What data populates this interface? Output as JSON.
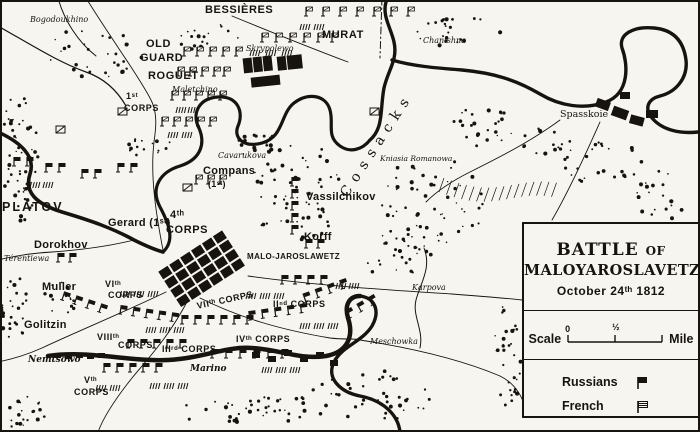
{
  "colors": {
    "ink": "#17140f",
    "paper": "#f7f5f0"
  },
  "map": {
    "labels": [
      {
        "id": "bogodoukhino",
        "text": "Bogodoukhino",
        "x": 30,
        "y": 16,
        "cls": "it"
      },
      {
        "id": "bessieres",
        "text": "BESSIÈRES",
        "x": 205,
        "y": 5,
        "cls": "caps md"
      },
      {
        "id": "murat",
        "text": "MURAT",
        "x": 322,
        "y": 30,
        "cls": "caps md"
      },
      {
        "id": "skrypolewo",
        "text": "Skrypolewo",
        "x": 246,
        "y": 45,
        "cls": "it"
      },
      {
        "id": "old-guard-1",
        "text": "OLD",
        "x": 146,
        "y": 39,
        "cls": "caps md"
      },
      {
        "id": "old-guard-2",
        "text": "GUARD",
        "x": 140,
        "y": 53,
        "cls": "caps md"
      },
      {
        "id": "roguet",
        "text": "ROGUET",
        "x": 148,
        "y": 71,
        "cls": "caps md"
      },
      {
        "id": "maletchino",
        "text": "Maletchino",
        "x": 172,
        "y": 86,
        "cls": "it"
      },
      {
        "id": "corps1-a",
        "text": "1ˢᵗ",
        "x": 126,
        "y": 92,
        "cls": "caps sm"
      },
      {
        "id": "corps1-b",
        "text": "CORPS",
        "x": 124,
        "y": 104,
        "cls": "caps sm"
      },
      {
        "id": "cossacks",
        "text": "Cossacks",
        "x": 338,
        "y": 192,
        "cls": "cossacks",
        "rot": -57
      },
      {
        "id": "chanishna",
        "text": "Chanishna",
        "x": 423,
        "y": 37,
        "cls": "it"
      },
      {
        "id": "spasskoie",
        "text": "Spasskoie",
        "x": 560,
        "y": 110,
        "cls": "rm"
      },
      {
        "id": "cavarukova",
        "text": "Cavarukova",
        "x": 218,
        "y": 152,
        "cls": "it"
      },
      {
        "id": "compans-a",
        "text": "Compans",
        "x": 203,
        "y": 166,
        "cls": "hand"
      },
      {
        "id": "compans-b",
        "text": "(1ˢᵗ)",
        "x": 208,
        "y": 180,
        "cls": "hand sm"
      },
      {
        "id": "vassilchikov",
        "text": "Vassilchikov",
        "x": 306,
        "y": 192,
        "cls": "hand"
      },
      {
        "id": "korff",
        "text": "Korff",
        "x": 304,
        "y": 232,
        "cls": "hand"
      },
      {
        "id": "kniasia-romanowa",
        "text": "Kniasia Romanowa",
        "x": 380,
        "y": 155,
        "cls": "rm xs"
      },
      {
        "id": "platov",
        "text": "PLATOV",
        "x": 2,
        "y": 201,
        "cls": "caps lg"
      },
      {
        "id": "corps4-a",
        "text": "4ᵗʰ",
        "x": 170,
        "y": 210,
        "cls": "caps md"
      },
      {
        "id": "corps4-b",
        "text": "CORPS",
        "x": 166,
        "y": 225,
        "cls": "caps md"
      },
      {
        "id": "gerard",
        "text": "Gerard (1ˢᵗ)",
        "x": 108,
        "y": 218,
        "cls": "hand"
      },
      {
        "id": "dorokhov",
        "text": "Dorokhov",
        "x": 34,
        "y": 240,
        "cls": "hand"
      },
      {
        "id": "terentiewa",
        "text": "Térentiewa",
        "x": 4,
        "y": 255,
        "cls": "it"
      },
      {
        "id": "malo-jaroslawetz",
        "text": "MALO-JAROSLAWETZ",
        "x": 247,
        "y": 253,
        "cls": "town"
      },
      {
        "id": "muller",
        "text": "Muller",
        "x": 42,
        "y": 282,
        "cls": "hand"
      },
      {
        "id": "corps6-a",
        "text": "VIᵗʰ",
        "x": 105,
        "y": 280,
        "cls": "caps sm"
      },
      {
        "id": "corps6-b",
        "text": "CORPS",
        "x": 108,
        "y": 291,
        "cls": "caps sm"
      },
      {
        "id": "golitzin",
        "text": "Golitzin",
        "x": 24,
        "y": 320,
        "cls": "hand"
      },
      {
        "id": "corps8-a",
        "text": "VIIIᵗʰ",
        "x": 97,
        "y": 333,
        "cls": "caps sm"
      },
      {
        "id": "corps8-b",
        "text": "CORPS",
        "x": 118,
        "y": 341,
        "cls": "caps sm"
      },
      {
        "id": "nemtsowo",
        "text": "Nemtsowo",
        "x": 28,
        "y": 356,
        "cls": "it b"
      },
      {
        "id": "corps5-a",
        "text": "Vᵗʰ",
        "x": 84,
        "y": 376,
        "cls": "caps sm"
      },
      {
        "id": "corps5-b",
        "text": "CORPS",
        "x": 74,
        "y": 388,
        "cls": "caps sm"
      },
      {
        "id": "corps7",
        "text": "VIIᵗʰ CORPS",
        "x": 196,
        "y": 302,
        "cls": "caps sm",
        "rot": -12
      },
      {
        "id": "corps3",
        "text": "IIIʳᵈ CORPS",
        "x": 162,
        "y": 345,
        "cls": "caps sm"
      },
      {
        "id": "corps4iv",
        "text": "IVᵗʰ CORPS",
        "x": 236,
        "y": 335,
        "cls": "caps sm"
      },
      {
        "id": "corps2",
        "text": "IIⁿᵈ CORPS",
        "x": 273,
        "y": 300,
        "cls": "caps sm"
      },
      {
        "id": "marino",
        "text": "Marino",
        "x": 190,
        "y": 365,
        "cls": "it b"
      },
      {
        "id": "karpova",
        "text": "Karpova",
        "x": 412,
        "y": 284,
        "cls": "it"
      },
      {
        "id": "meschowka",
        "text": "Meschowka",
        "x": 370,
        "y": 338,
        "cls": "it"
      }
    ],
    "units": [
      {
        "x": 306,
        "y": 16,
        "n": 7,
        "g": 17,
        "t": "french"
      },
      {
        "x": 300,
        "y": 30,
        "n": 2,
        "g": 14,
        "t": "hash"
      },
      {
        "x": 262,
        "y": 42,
        "n": 6,
        "g": 14,
        "t": "french"
      },
      {
        "x": 250,
        "y": 56,
        "n": 3,
        "g": 16,
        "t": "hash"
      },
      {
        "x": 184,
        "y": 56,
        "n": 5,
        "g": 13,
        "t": "french"
      },
      {
        "x": 178,
        "y": 76,
        "n": 4,
        "g": 12,
        "t": "french"
      },
      {
        "x": 224,
        "y": 76,
        "n": 1,
        "g": 12,
        "t": "french"
      },
      {
        "x": 172,
        "y": 100,
        "n": 5,
        "g": 12,
        "t": "french"
      },
      {
        "x": 176,
        "y": 113,
        "n": 2,
        "g": 12,
        "t": "hash"
      },
      {
        "x": 162,
        "y": 126,
        "n": 5,
        "g": 12,
        "t": "french"
      },
      {
        "x": 168,
        "y": 138,
        "n": 2,
        "g": 14,
        "t": "hash"
      },
      {
        "x": 196,
        "y": 184,
        "n": 3,
        "g": 12,
        "t": "french"
      },
      {
        "x": 14,
        "y": 166,
        "n": 2,
        "g": 13,
        "t": "russian"
      },
      {
        "x": 46,
        "y": 172,
        "n": 2,
        "g": 13,
        "t": "russian"
      },
      {
        "x": 82,
        "y": 178,
        "n": 2,
        "g": 13,
        "t": "russian"
      },
      {
        "x": 118,
        "y": 172,
        "n": 2,
        "g": 13,
        "t": "russian"
      },
      {
        "x": 30,
        "y": 188,
        "n": 2,
        "g": 13,
        "t": "hash"
      },
      {
        "x": 292,
        "y": 186,
        "n": 5,
        "g": 12,
        "t": "russian",
        "vert": true
      },
      {
        "x": 306,
        "y": 248,
        "n": 2,
        "g": 12,
        "t": "russian"
      },
      {
        "x": 58,
        "y": 262,
        "n": 2,
        "g": 12,
        "t": "russian"
      },
      {
        "x": 62,
        "y": 300,
        "n": 4,
        "g": 13,
        "rot": 18,
        "t": "russian"
      },
      {
        "x": 120,
        "y": 314,
        "n": 5,
        "g": 13,
        "rot": 8,
        "t": "russian"
      },
      {
        "x": 182,
        "y": 324,
        "n": 6,
        "g": 13,
        "t": "russian"
      },
      {
        "x": 250,
        "y": 320,
        "n": 5,
        "g": 13,
        "rot": -8,
        "t": "russian"
      },
      {
        "x": 306,
        "y": 302,
        "n": 4,
        "g": 13,
        "rot": -20,
        "t": "russian"
      },
      {
        "x": 246,
        "y": 299,
        "n": 3,
        "g": 14,
        "t": "hash"
      },
      {
        "x": 146,
        "y": 333,
        "n": 3,
        "g": 14,
        "t": "hash"
      },
      {
        "x": 300,
        "y": 329,
        "n": 3,
        "g": 14,
        "t": "hash"
      },
      {
        "x": 128,
        "y": 348,
        "n": 5,
        "g": 13,
        "t": "russian"
      },
      {
        "x": 104,
        "y": 372,
        "n": 5,
        "g": 13,
        "t": "russian"
      },
      {
        "x": 150,
        "y": 389,
        "n": 3,
        "g": 14,
        "t": "hash"
      },
      {
        "x": 96,
        "y": 391,
        "n": 2,
        "g": 14,
        "t": "hash"
      },
      {
        "x": 212,
        "y": 358,
        "n": 6,
        "g": 14,
        "t": "russian"
      },
      {
        "x": 262,
        "y": 373,
        "n": 3,
        "g": 14,
        "t": "hash"
      },
      {
        "x": 282,
        "y": 284,
        "n": 4,
        "g": 13,
        "t": "russian"
      },
      {
        "x": 336,
        "y": 289,
        "n": 2,
        "g": 13,
        "t": "hash"
      },
      {
        "x": 350,
        "y": 318,
        "n": 3,
        "g": 13,
        "rot": -30,
        "t": "russian"
      },
      {
        "x": 120,
        "y": 297,
        "n": 3,
        "g": 14,
        "t": "hash"
      }
    ]
  },
  "legend": {
    "title_a": "BATTLE",
    "title_b": "OF",
    "title_line2": "MALOYAROSLAVETZ",
    "date": "October 24ᵗʰ 1812",
    "scale": {
      "label": "Scale",
      "ticks": [
        "0",
        "½"
      ],
      "unit": "Mile"
    },
    "entries": [
      {
        "label": "Russians",
        "symbol": "russian-flag"
      },
      {
        "label": "French",
        "symbol": "french-flag"
      }
    ]
  }
}
